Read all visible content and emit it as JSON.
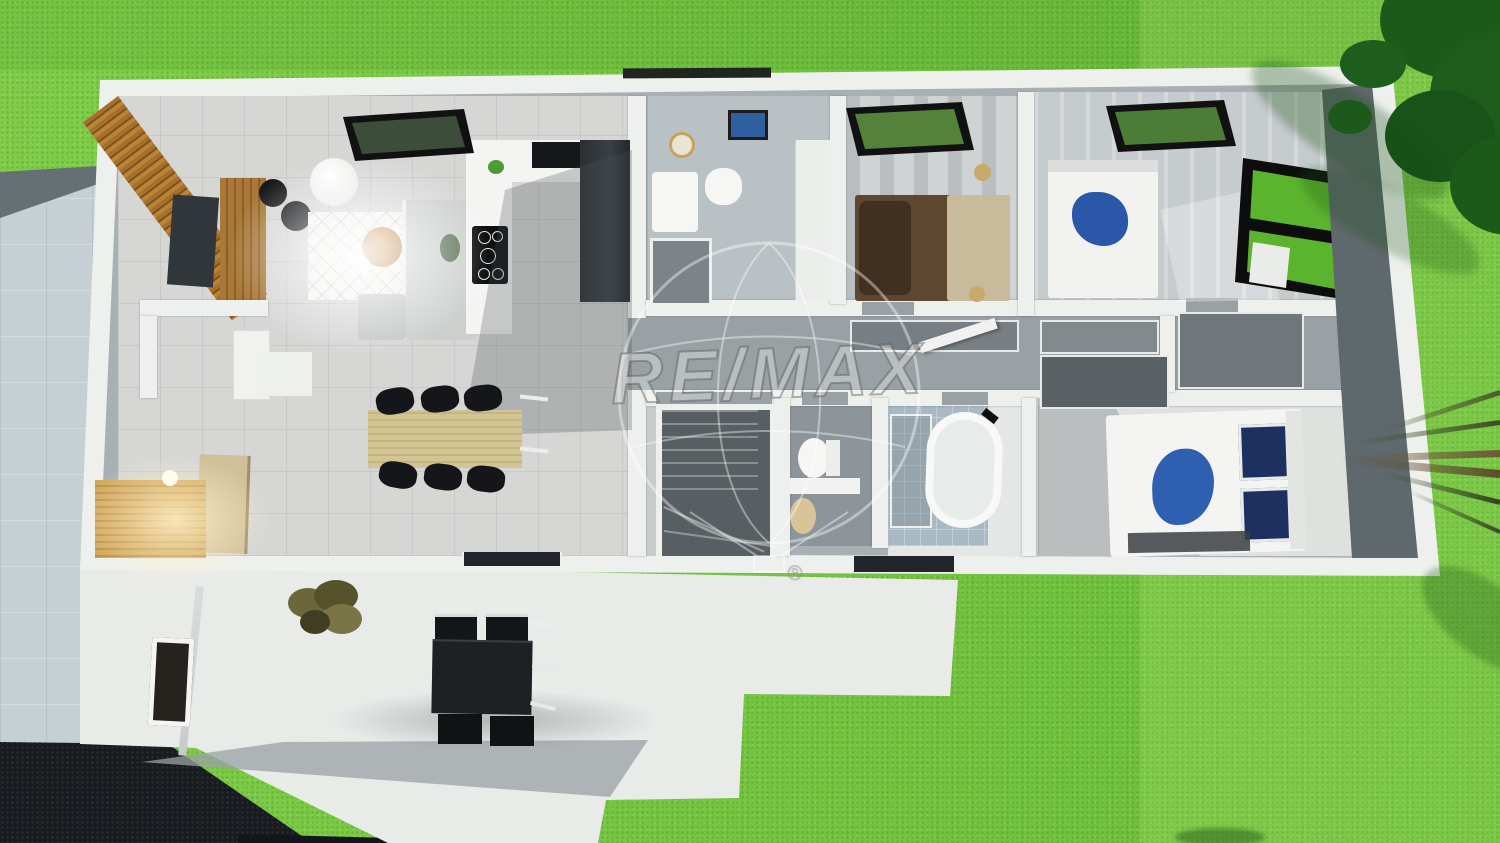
{
  "watermark": {
    "brand": "RE/MAX",
    "registered": "®"
  },
  "palette": {
    "grass": "#74c73e",
    "tree_canopy": "#1c5a1a",
    "house_wall": "#eef0ee",
    "interior_gray": "#9aa1a5",
    "living_floor": "#d6d7d5",
    "wood_slats": "#a5702c",
    "dining_table_wood": "#d2c493",
    "sofa_gray": "#ccd0cd",
    "bed_brown": "#5d4730",
    "bed_blue": "#2b57a9",
    "navy_pillow": "#1d3161",
    "tub_white": "#f7f8f7",
    "dark_furniture": "#1e2124",
    "paving": "#c6cfd4",
    "asphalt": "#181c20",
    "gold_table": "#c08b4f",
    "skylight_frame": "#111111",
    "window_green": "#5cb32e"
  },
  "inventory": {
    "skylights": 3,
    "bedrooms": 3,
    "bathrooms": 2,
    "wc": 1,
    "dining_chairs": 6,
    "terrace_chairs": 4,
    "beds": 3,
    "bathtub": 1,
    "staircase": 1
  }
}
